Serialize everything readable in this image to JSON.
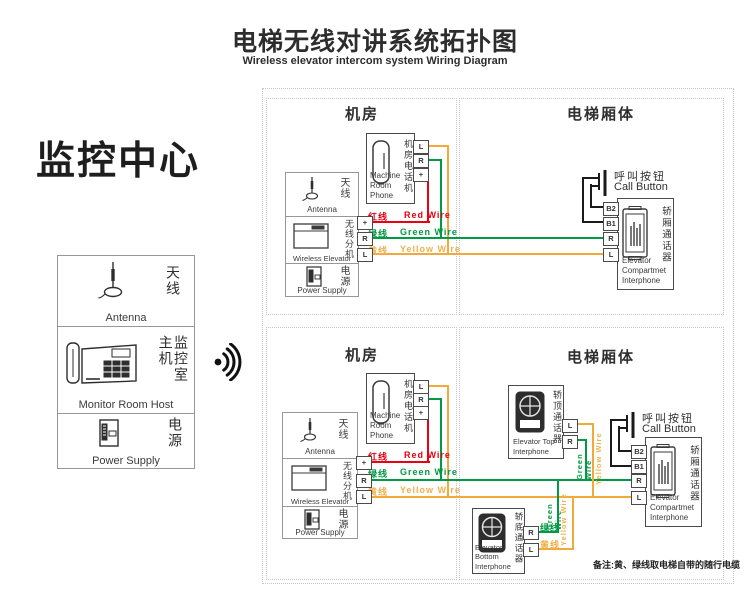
{
  "header": {
    "title_cn": "电梯无线对讲系统拓扑图",
    "title_en": "Wireless elevator intercom system Wiring Diagram"
  },
  "monitor_center": {
    "heading": "监控中心",
    "antenna_cn": "天线",
    "antenna_en": "Antenna",
    "host_cn": "监控室主机",
    "host_en": "Monitor Room Host",
    "power_cn": "电源",
    "power_en": "Power Supply"
  },
  "sections": {
    "machine_room": "机房",
    "elevator_body": "电梯厢体"
  },
  "wires": {
    "red_cn": "红线",
    "red_en": "Red Wire",
    "green_cn": "绿线",
    "green_en": "Green Wire",
    "yellow_cn": "黄线",
    "yellow_en": "Yellow Wire",
    "green_vert": "Green Wire",
    "yellow_vert": "Yellow Wire"
  },
  "devices": {
    "machine_room_phone": {
      "cn": "机房电话机",
      "en": "Machine\nRoom Phone",
      "terminals": [
        "L",
        "R",
        "+"
      ]
    },
    "wireless_unit": {
      "antenna_cn": "天线",
      "antenna_en": "Antenna",
      "wireless_cn": "无线分机",
      "wireless_en": "Wireless Elevator",
      "power_cn": "电源",
      "power_en": "Power Supply",
      "terminals": [
        "+",
        "R",
        "L"
      ]
    },
    "call_button": {
      "cn": "呼叫按钮",
      "en": "Call Button"
    },
    "compartment_interphone": {
      "cn": "轿厢通话器",
      "en": "Elevator\nCompartmet\nInterphone",
      "terminals": [
        "B2",
        "B1",
        "R",
        "L"
      ]
    },
    "top_interphone": {
      "cn": "轿顶通话器",
      "en": "Elevator Top\nInterphone",
      "terminals": [
        "L",
        "R"
      ]
    },
    "bottom_interphone": {
      "cn": "轿底通话器",
      "en": "Elevator Bottom\nInterphone",
      "terminals": [
        "R",
        "L"
      ]
    }
  },
  "note": "备注:黄、绿线取电梯自带的随行电缆",
  "colors": {
    "red": "#e60012",
    "green": "#009944",
    "yellow": "#f2a93b"
  }
}
